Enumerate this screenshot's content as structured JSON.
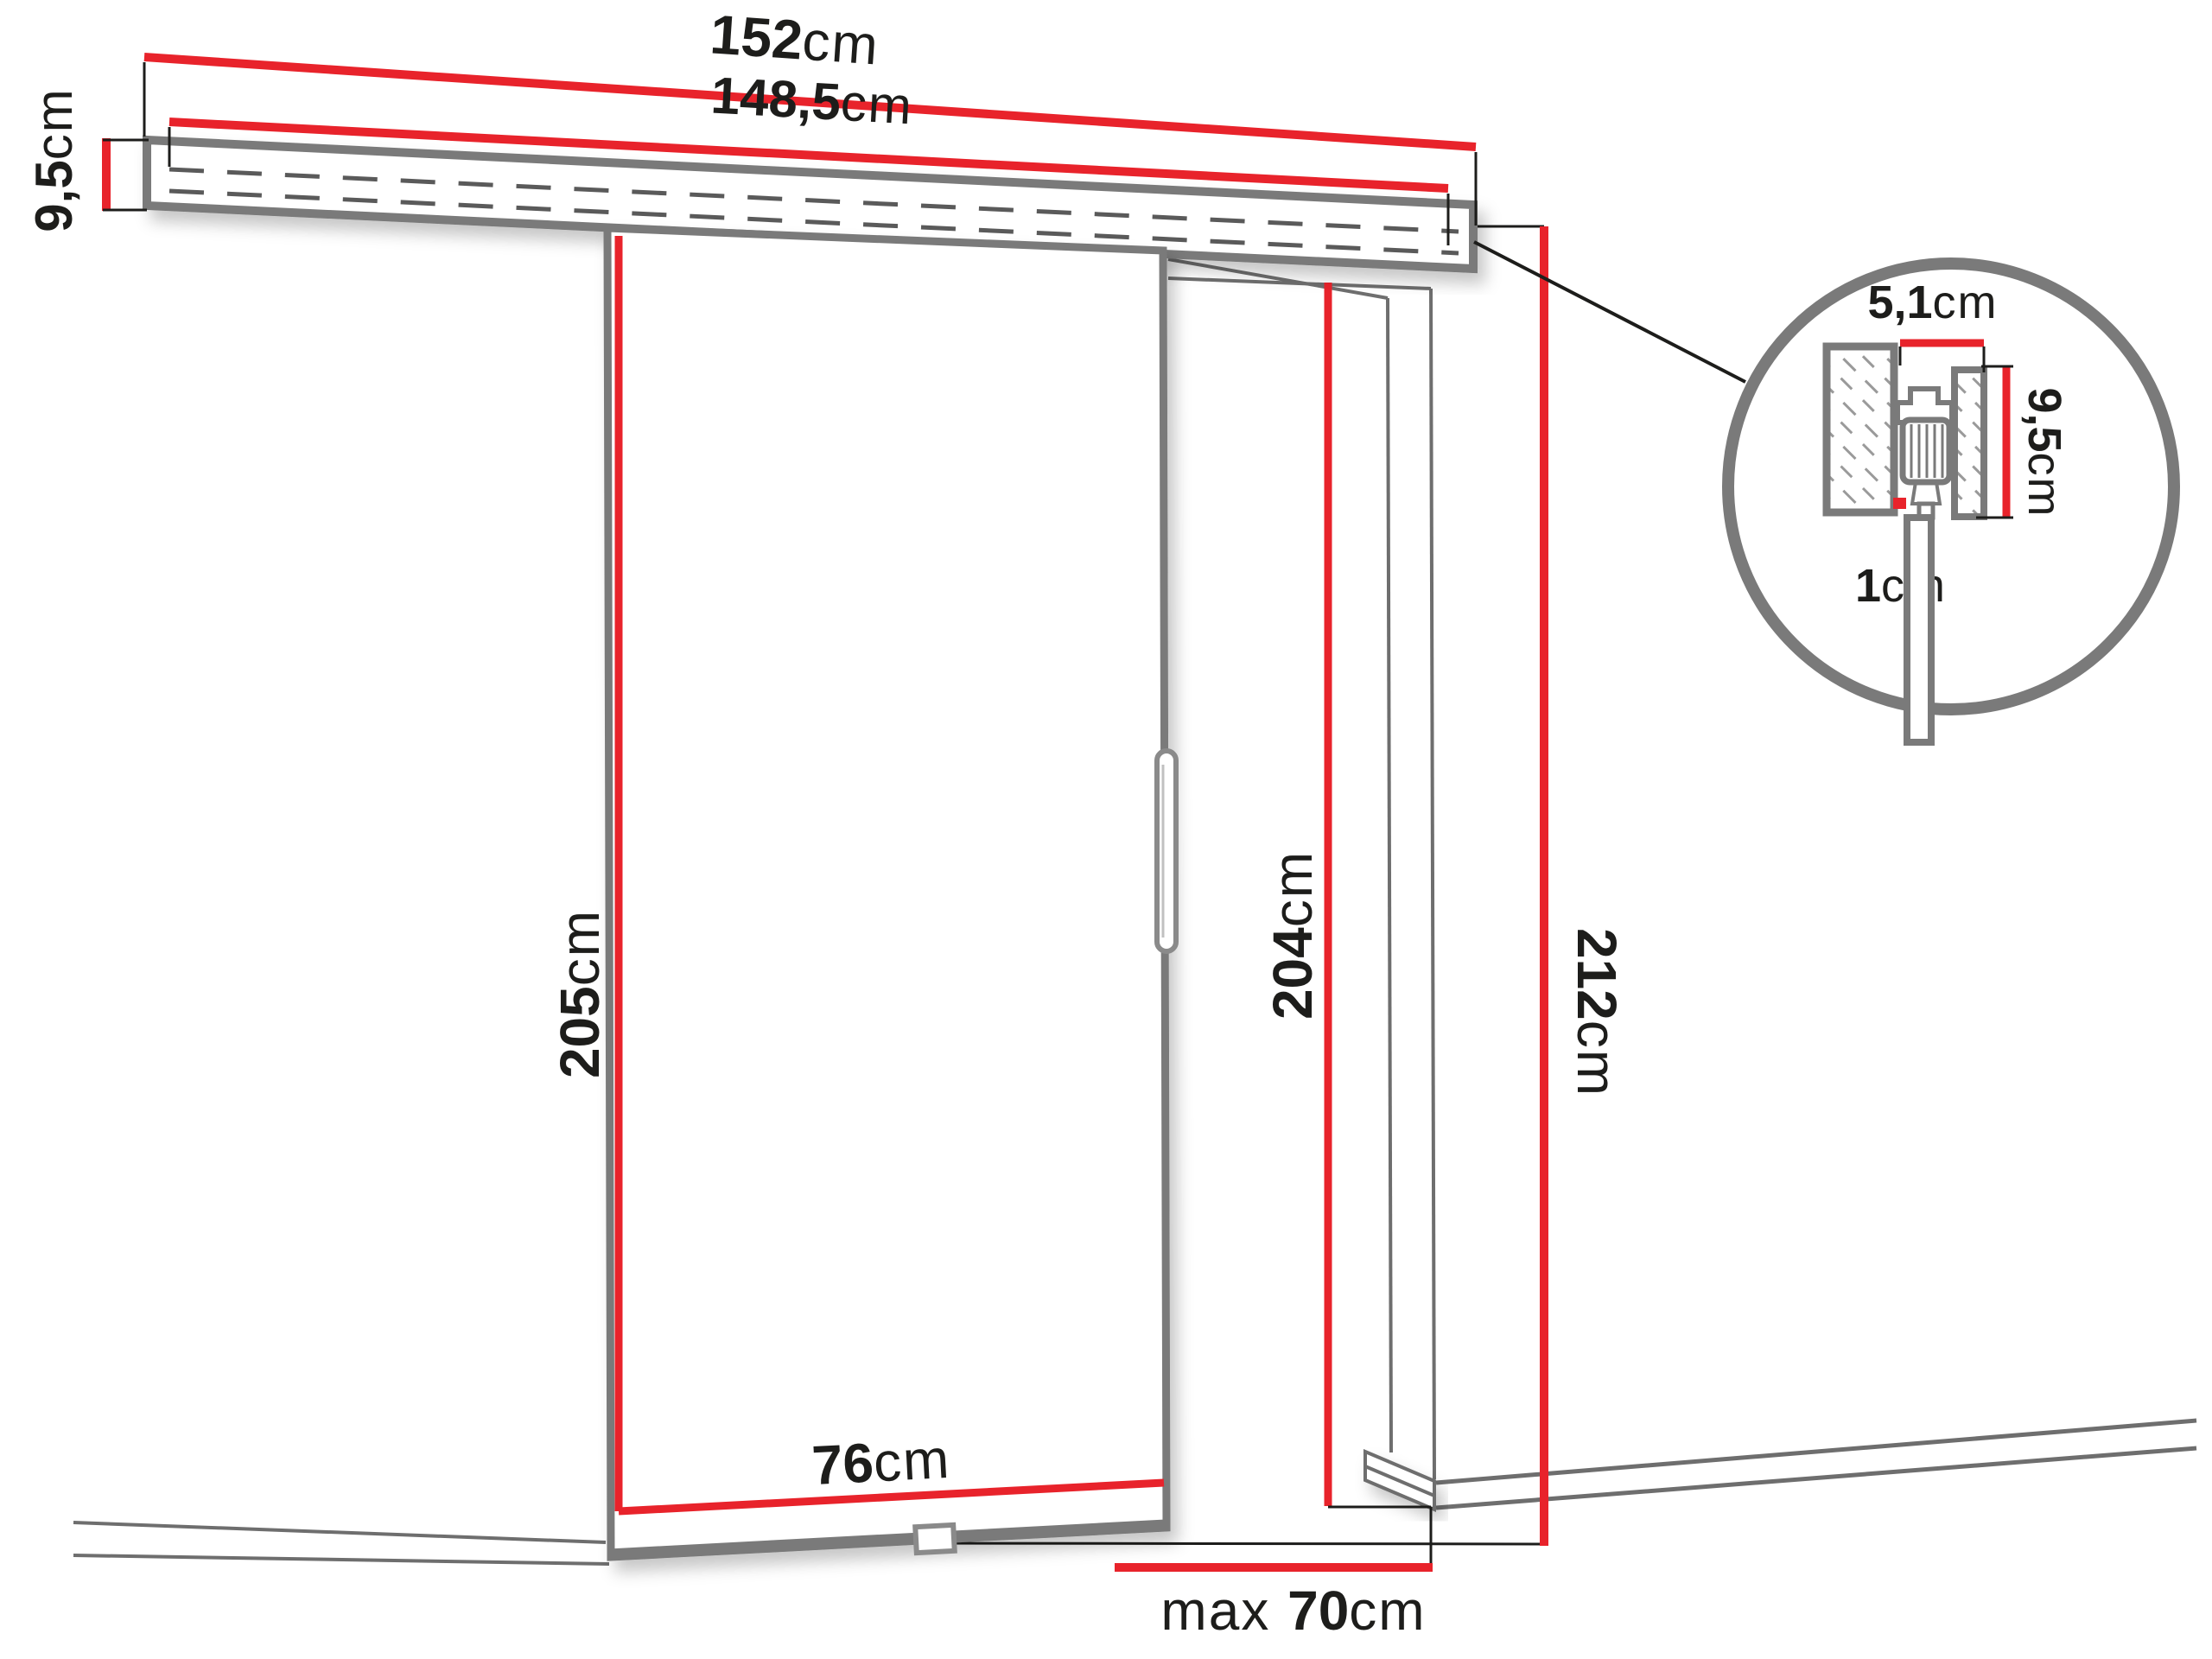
{
  "diagram": {
    "title": "sliding-door-dimension-diagram",
    "labels": {
      "rail_total_width": {
        "value": "152",
        "unit": "cm"
      },
      "rail_inner_width": {
        "value": "148,5",
        "unit": "cm"
      },
      "rail_height_left": {
        "value": "9,5",
        "unit": "cm"
      },
      "door_height": {
        "value": "205",
        "unit": "cm"
      },
      "door_width": {
        "value": "76",
        "unit": "cm"
      },
      "opening_height": {
        "value": "204",
        "unit": "cm"
      },
      "total_height": {
        "value": "212",
        "unit": "cm"
      },
      "opening_width": {
        "prefix": "max ",
        "value": "70",
        "unit": "cm"
      },
      "detail_track_width": {
        "value": "5,1",
        "unit": "cm"
      },
      "detail_track_height": {
        "value": "9,5",
        "unit": "cm"
      },
      "detail_floor_gap": {
        "value": "1",
        "unit": "cm"
      }
    },
    "colors": {
      "dimension_red": "#e8232b",
      "outline_gray": "#7a7a7a",
      "thin_line": "#1d1d1b",
      "text": "#1d1d1b",
      "background": "#ffffff"
    }
  }
}
